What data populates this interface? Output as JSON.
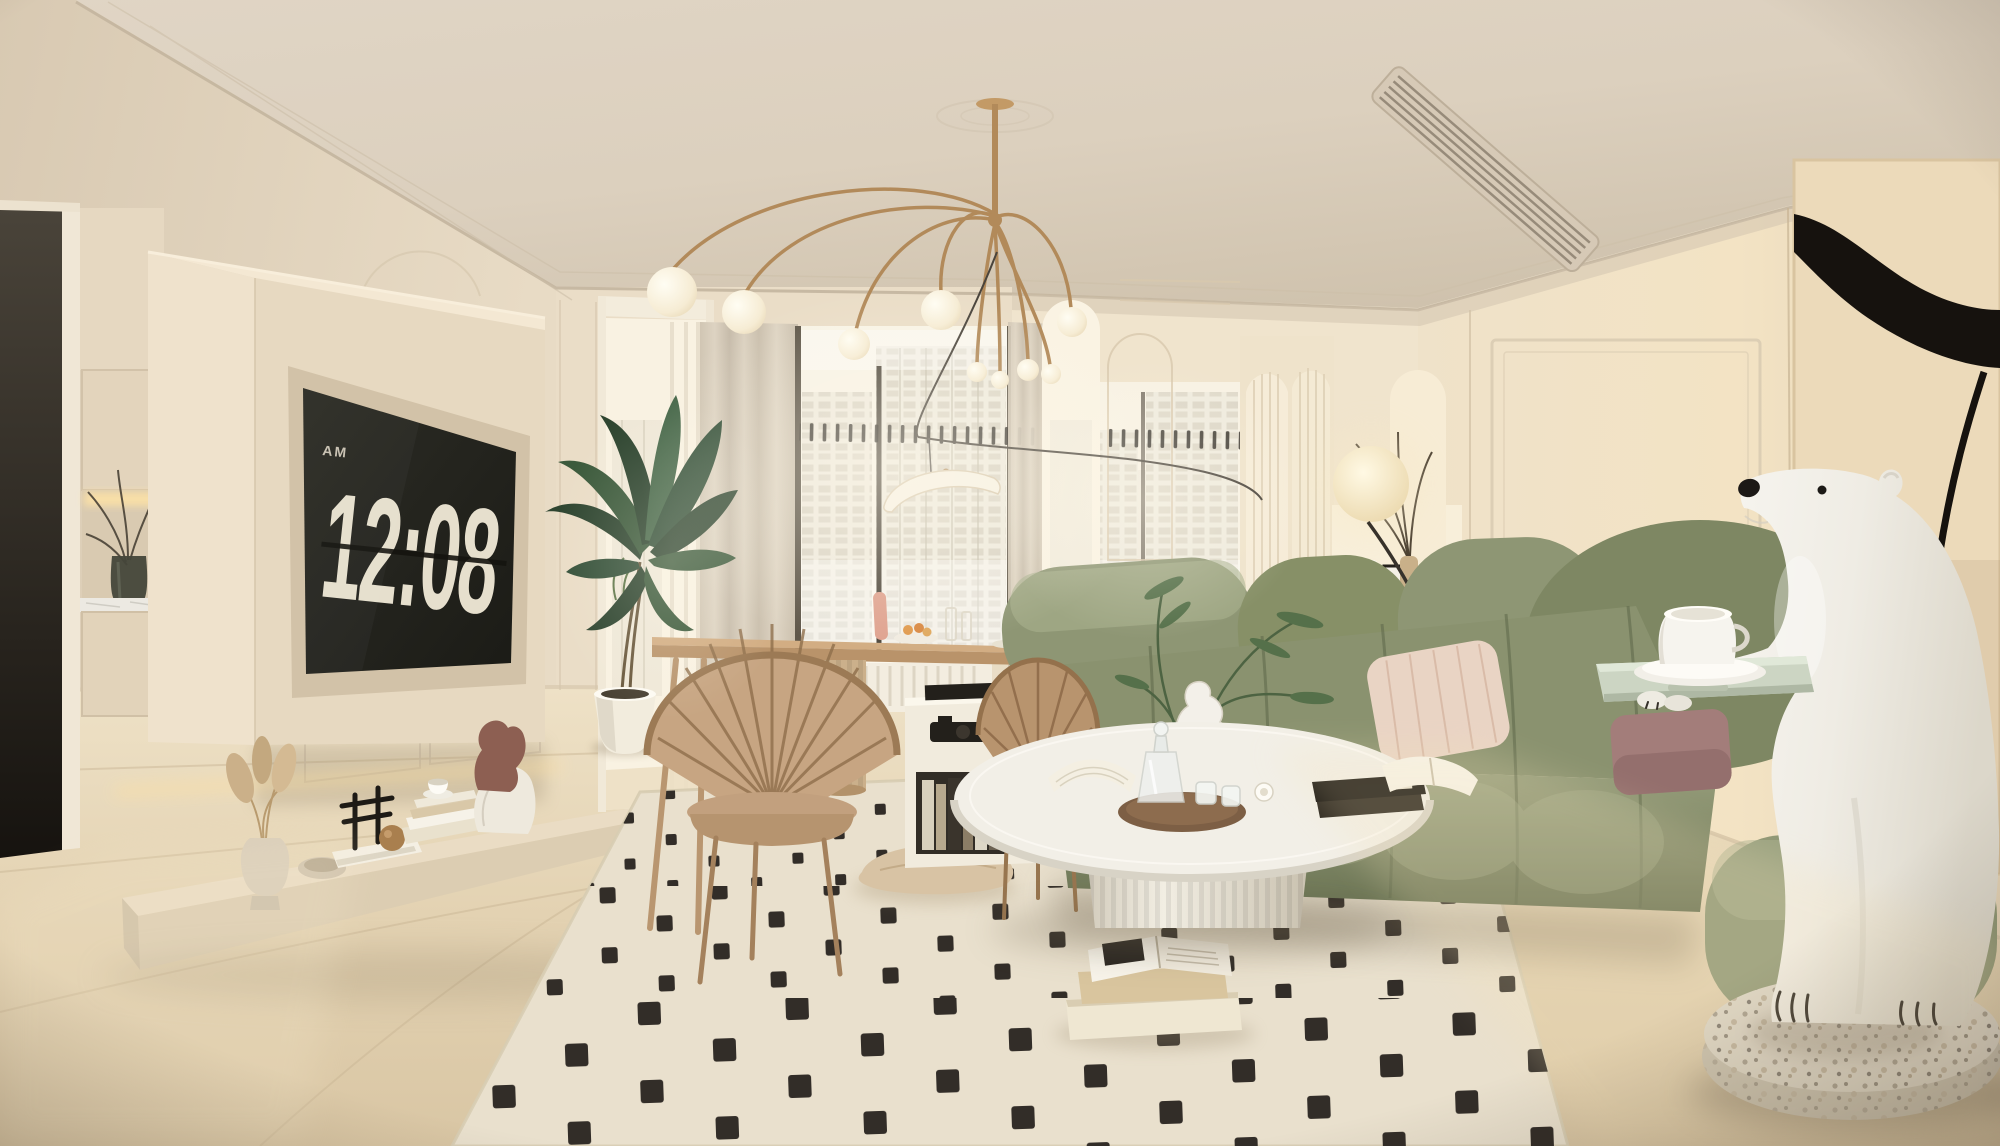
{
  "meta": {
    "title": "Cream modern living room interior render",
    "style": "warm beige French-modern apartment, 3D architectural render",
    "time_of_day_shown_on_tv": "12:08 AM"
  },
  "clock": {
    "meridiem": "AM",
    "time": "12:08"
  },
  "palette": {
    "ceiling": "#ded3c2",
    "wall_cream": "#e9dcc6",
    "floor": "#e0cfae",
    "doorway_dark": "#241f19",
    "tv_screen": "#26261f",
    "clock_text": "#e6dfcd",
    "brass": "#b28a5a",
    "sofa_green": "#8e9674",
    "sofa_green_dark": "#6e7757",
    "rug_cream": "#e8dfca",
    "rug_dot": "#26201b",
    "wood_tan": "#c6a27a",
    "plant_green": "#3c5438",
    "orange": "#e0802f",
    "amber_glass": "#c27d33",
    "terrazzo": "#dcd5c8",
    "bear_white": "#f3f1ea",
    "tray_mint": "#ccd5c3",
    "pillow_blush": "#e9d4c4",
    "pillow_mauve": "#a37d7a",
    "art_canvas": "#ecdaba",
    "art_black": "#16120e"
  },
  "scene": {
    "window_view": "white high-rise city towers in bright daylight",
    "objects": [
      "floating tv wall with flip-clock screen",
      "low plinth shelf with pampas vase, bowl, books, sculpture, teacup, torso statue",
      "dark side doorway and cabinet niche with branch vase",
      "dining table with fluted pedestal and fan-back chairs",
      "tall palm plant in white pot",
      "brass fountain chandelier with glass globes",
      "crescent pendant lamp on swag cable",
      "sheer curtains and curtain track",
      "white cube shelf with books",
      "kitchen island with bowl of oranges",
      "arched ribbed-glass cabinets and kitchen counter",
      "moon globe floor lamp",
      "green tufted modular sofa with blush striped and mauve pillows",
      "cream rug with black checker dots",
      "round white fluted coffee table with tray, decanter and books",
      "amber glass side table with abstract figurine",
      "floor cushion and stacked books on rug",
      "polar bear statue holding mint tray with teacup",
      "terrazzo oval base",
      "abstract black-line wall art",
      "linear ac vent in ceiling bulkhead"
    ]
  }
}
